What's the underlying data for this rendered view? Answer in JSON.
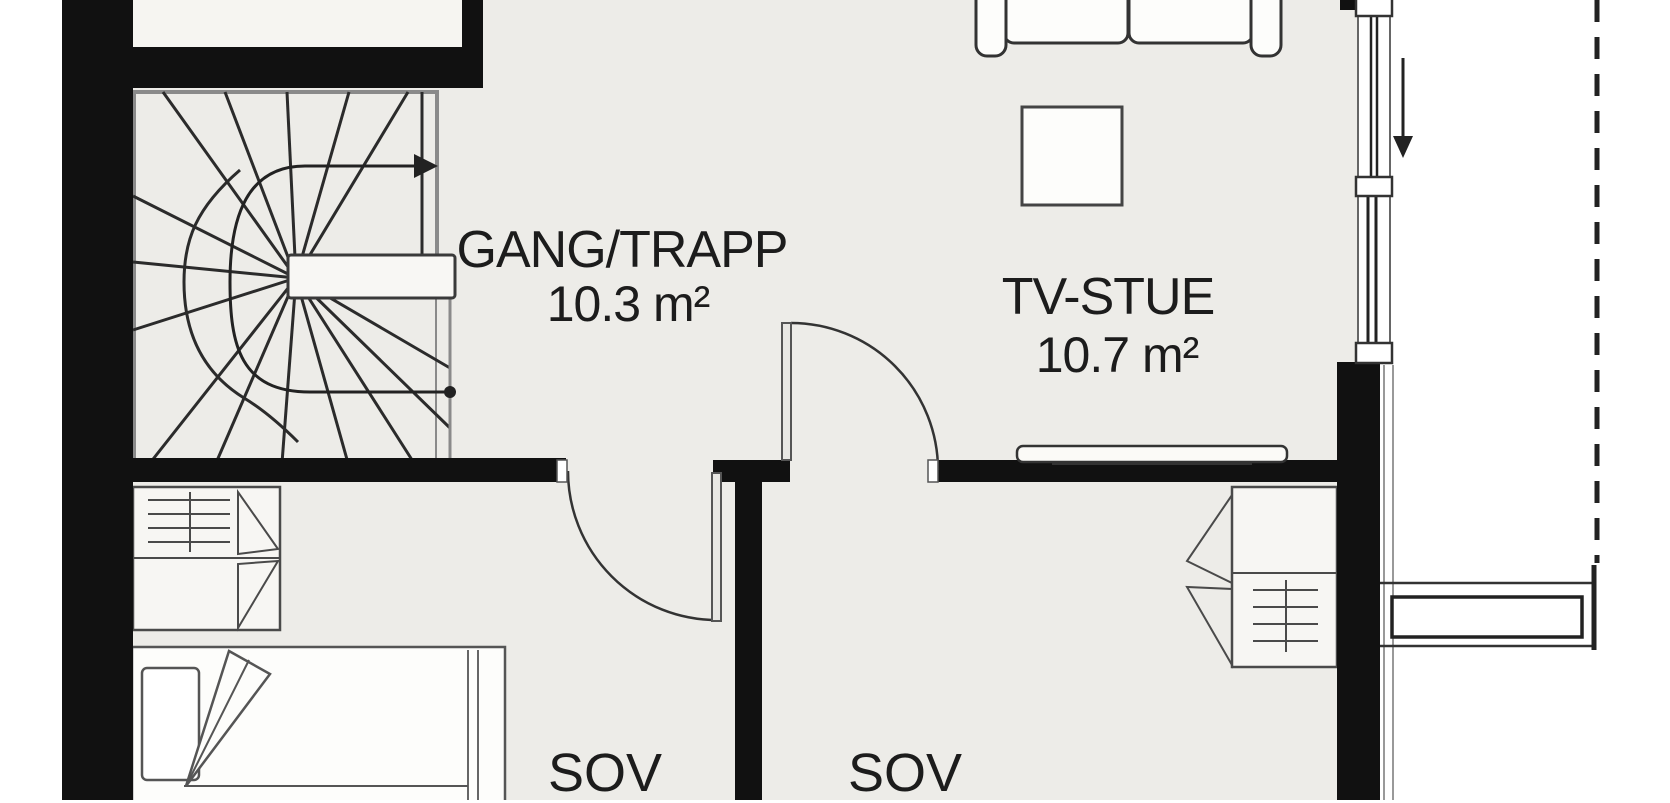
{
  "colors": {
    "wall": "#111111",
    "floor": "#edece8",
    "floorlight": "#f6f5f1",
    "outside": "#ffffff",
    "ink": "#1c1c1c",
    "line": "#3a3a3a",
    "stairborder": "#8a8a8a",
    "furnfill": "#fdfdfb"
  },
  "rooms": [
    {
      "id": "gang-trapp",
      "label": "GANG/TRAPP",
      "area": "10.3 m²"
    },
    {
      "id": "tv-stue",
      "label": "TV-STUE",
      "area": "10.7 m²"
    },
    {
      "id": "sov-left",
      "label": "SOV"
    },
    {
      "id": "sov-right",
      "label": "SOV"
    }
  ],
  "symbols": {
    "staircase": "winder-staircase-with-up-walkline-arrow",
    "doors": [
      "swing-door-to-left-bedroom",
      "swing-door-between-gang-and-tv-stue"
    ],
    "windows": [
      "window-right-upper",
      "window-right-lower"
    ],
    "furniture": [
      "sofa",
      "coffee-table",
      "tv-bench",
      "wardrobe-left-bedroom",
      "wardrobe-right-bedroom",
      "single-bed"
    ],
    "annotations": [
      "entry-direction-arrow",
      "roof-overhang-dashed-line",
      "entry-step"
    ]
  }
}
